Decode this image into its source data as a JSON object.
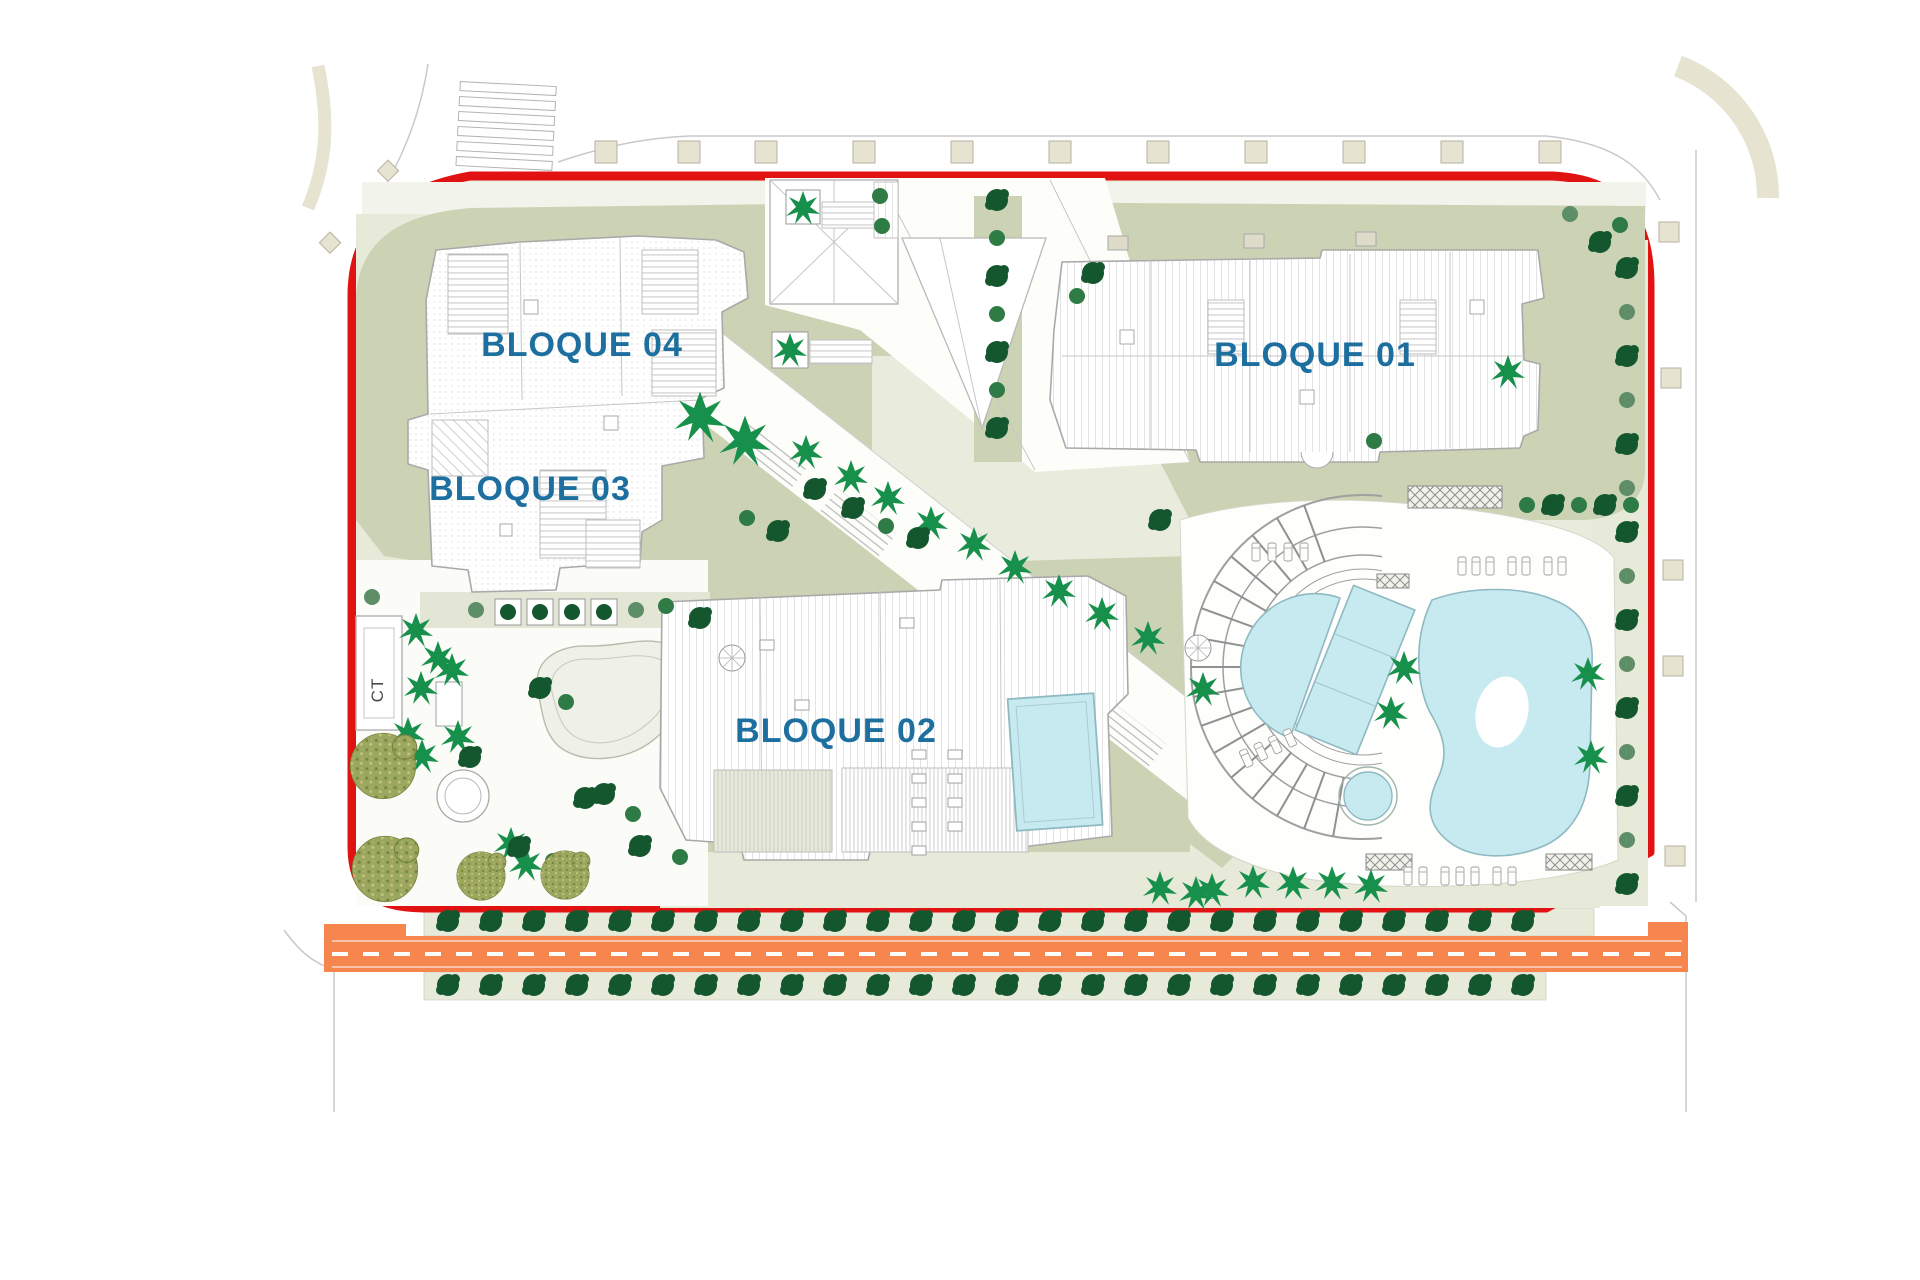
{
  "plan": {
    "type": "architectural-site-plan",
    "labels": {
      "block01": "BLOQUE 01",
      "block02": "BLOQUE 02",
      "block03": "BLOQUE 03",
      "block04": "BLOQUE 04",
      "transformer": "CT"
    },
    "colors": {
      "boundary": "#E01212",
      "road": "#F6864E",
      "road_dash": "#FFFFFF",
      "pool": "#C6EAF0",
      "pool_stroke": "#8FB9C2",
      "label": "#1D6F9F",
      "tree_dark": "#14572E",
      "tree_medium": "#2E7B45",
      "tree_sage": "#5E8E68",
      "palm": "#17904B",
      "olive": "#9AA75F",
      "lawn": "#CCD3B5",
      "ground": "#E9EBDC",
      "pale": "#E7E9D9"
    }
  }
}
